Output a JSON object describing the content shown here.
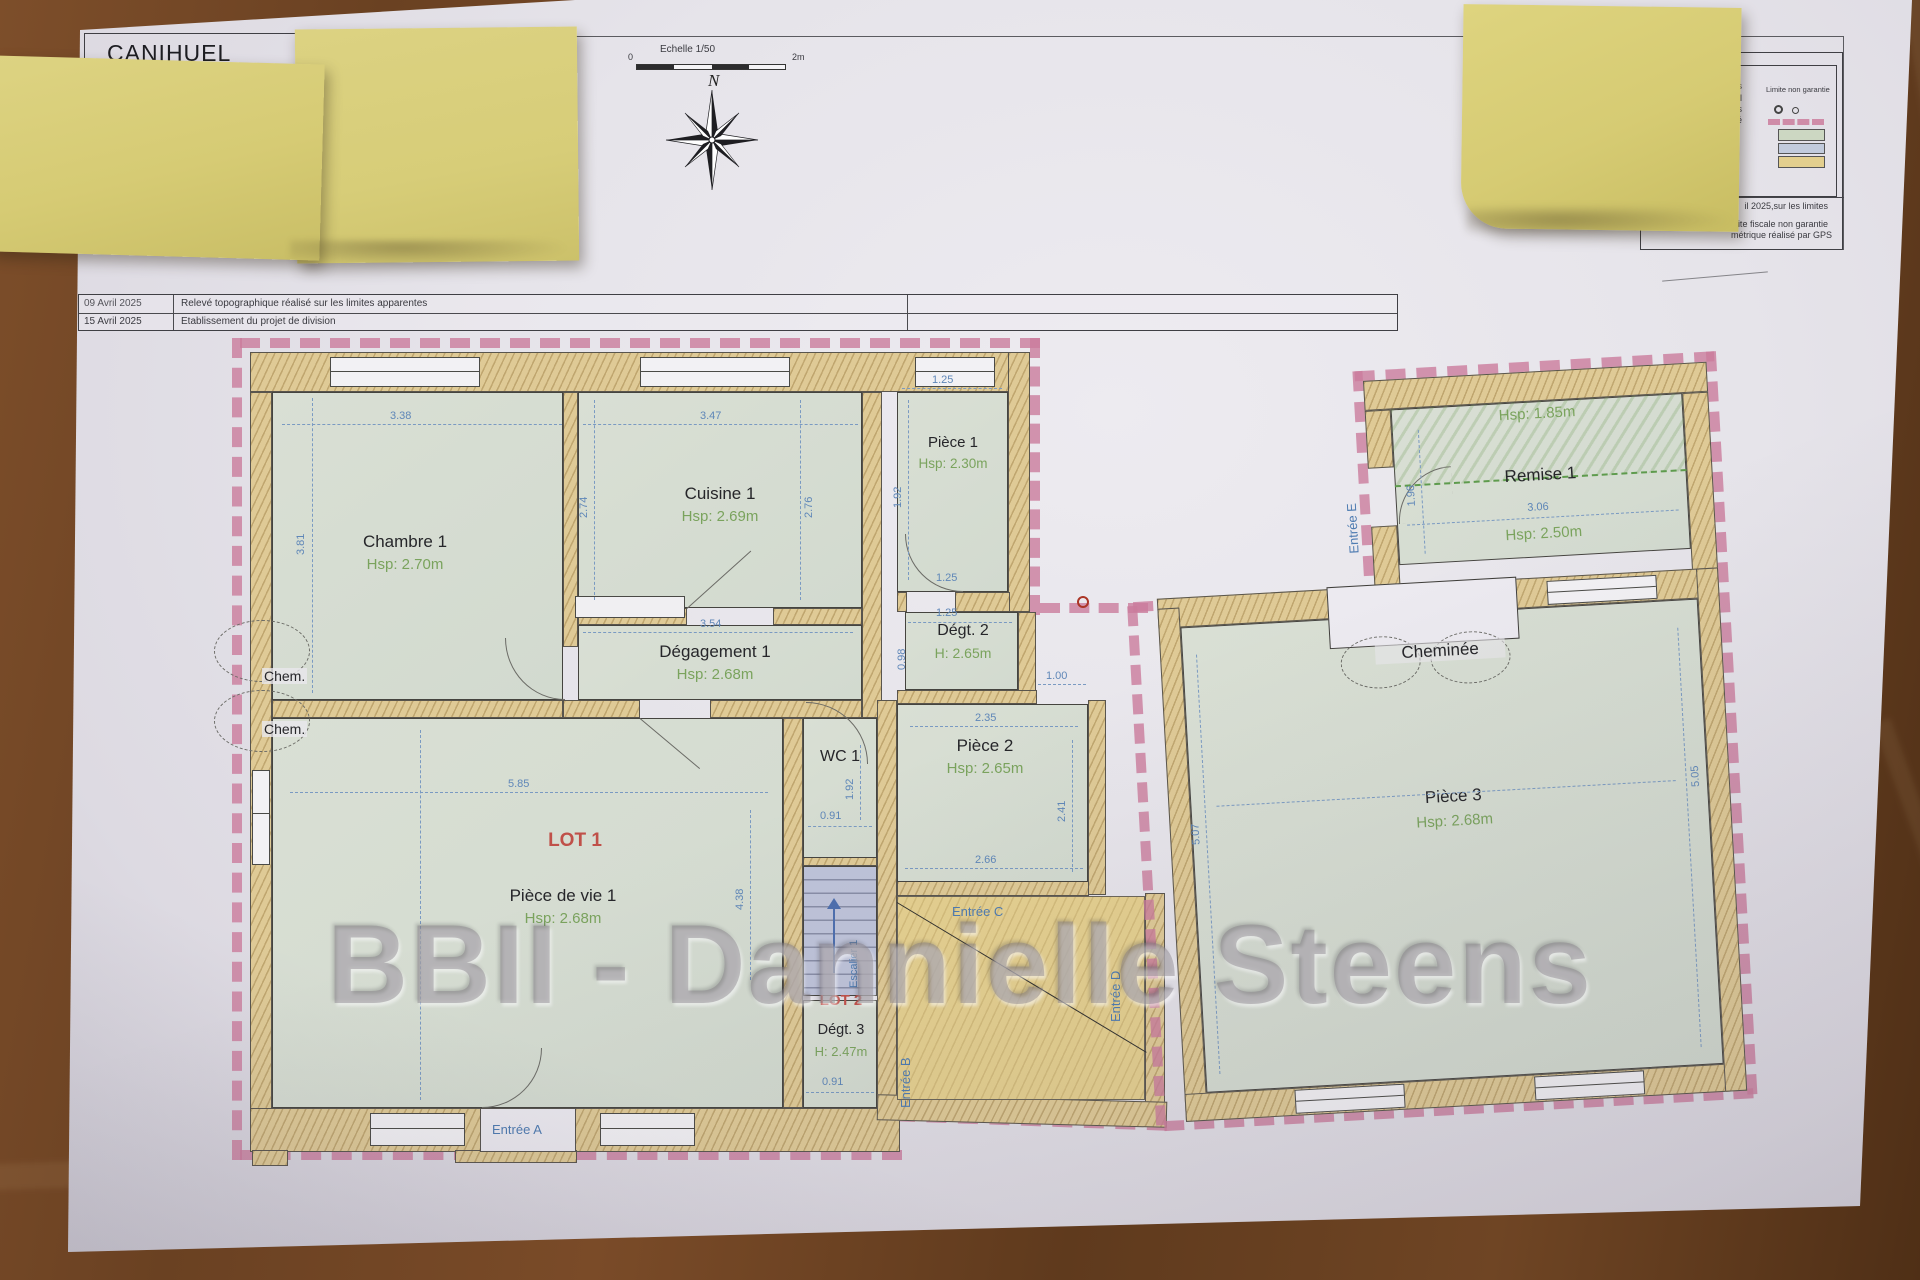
{
  "sheet": {
    "title": "CANIHUEL",
    "scale_label": "Echelle 1/50",
    "scale_zero": "0",
    "scale_end": "2m",
    "north": "N",
    "revisions": {
      "r1_date": "09 Avril 2025",
      "r1_desc": "Relevé topographique réalisé sur les limites apparentes",
      "r2_date": "15 Avril 2025",
      "r2_desc": "Etablissement du projet de division"
    }
  },
  "legend": {
    "row1": "trais",
    "row2": "cadastral",
    "row3": "xistants",
    "row4": "ropriété",
    "limite": "Limite non garantie",
    "note1": "il 2025,sur les limites",
    "note2": "ite fiscale non garantie",
    "note3": "métrique réalisé par GPS",
    "swatch_room": "#ccd7c2",
    "swatch_blue": "#c2cbdc",
    "swatch_yellow": "#e3cf8e"
  },
  "watermark": "BBII - Dannielle Steens",
  "lots": {
    "lot1": "LOT 1",
    "lot2": "LOT 2"
  },
  "rooms": {
    "chambre1": {
      "name": "Chambre 1",
      "hsp": "Hsp: 2.70m"
    },
    "cuisine1": {
      "name": "Cuisine 1",
      "hsp": "Hsp: 2.69m"
    },
    "piece1": {
      "name": "Pièce 1",
      "hsp": "Hsp: 2.30m"
    },
    "degagement1": {
      "name": "Dégagement 1",
      "hsp": "Hsp: 2.68m"
    },
    "degt2": {
      "name": "Dégt. 2",
      "hsp": "H: 2.65m"
    },
    "wc1": {
      "name": "WC 1"
    },
    "piece2": {
      "name": "Pièce 2",
      "hsp": "Hsp: 2.65m"
    },
    "piecedevie1": {
      "name": "Pièce de vie 1",
      "hsp": "Hsp: 2.68m"
    },
    "degt3": {
      "name": "Dégt. 3",
      "hsp": "H: 2.47m"
    },
    "escalier1": {
      "name": "Escalier 1"
    },
    "remise1": {
      "name": "Remise 1",
      "hsp": "Hsp: 2.50m",
      "hsp_low": "Hsp: 1.85m"
    },
    "piece3": {
      "name": "Pièce 3",
      "hsp": "Hsp: 2.68m"
    },
    "cheminee": {
      "name": "Cheminée"
    },
    "chem1": "Chem.",
    "chem2": "Chem."
  },
  "entrances": {
    "a": "Entrée A",
    "b": "Entrée B",
    "c": "Entrée C",
    "d": "Entrée D",
    "e": "Entrée E"
  },
  "dims": {
    "chambre_w": "3.38",
    "chambre_h": "3.81",
    "cuisine_w": "3.47",
    "cuisine_h_l": "2.74",
    "cuisine_h_r": "2.76",
    "piece1_w": "1.25",
    "piece1_h": "1.92",
    "deg1_w": "3.54",
    "degt2_w1": "1.25",
    "degt2_w2": "1.25",
    "degt2_h": "0.98",
    "link_w": "1.00",
    "piece2_w": "2.35",
    "piece2_h": "2.41",
    "piece2_b": "2.66",
    "pdv_w": "5.85",
    "pdv_h": "4.38",
    "wc_h": "1.92",
    "wc_w": "0.91",
    "degt3_w": "0.91",
    "remise_w": "3.06",
    "remise_h": "1.96",
    "piece3_hl": "5.07",
    "piece3_hr": "5.05"
  }
}
